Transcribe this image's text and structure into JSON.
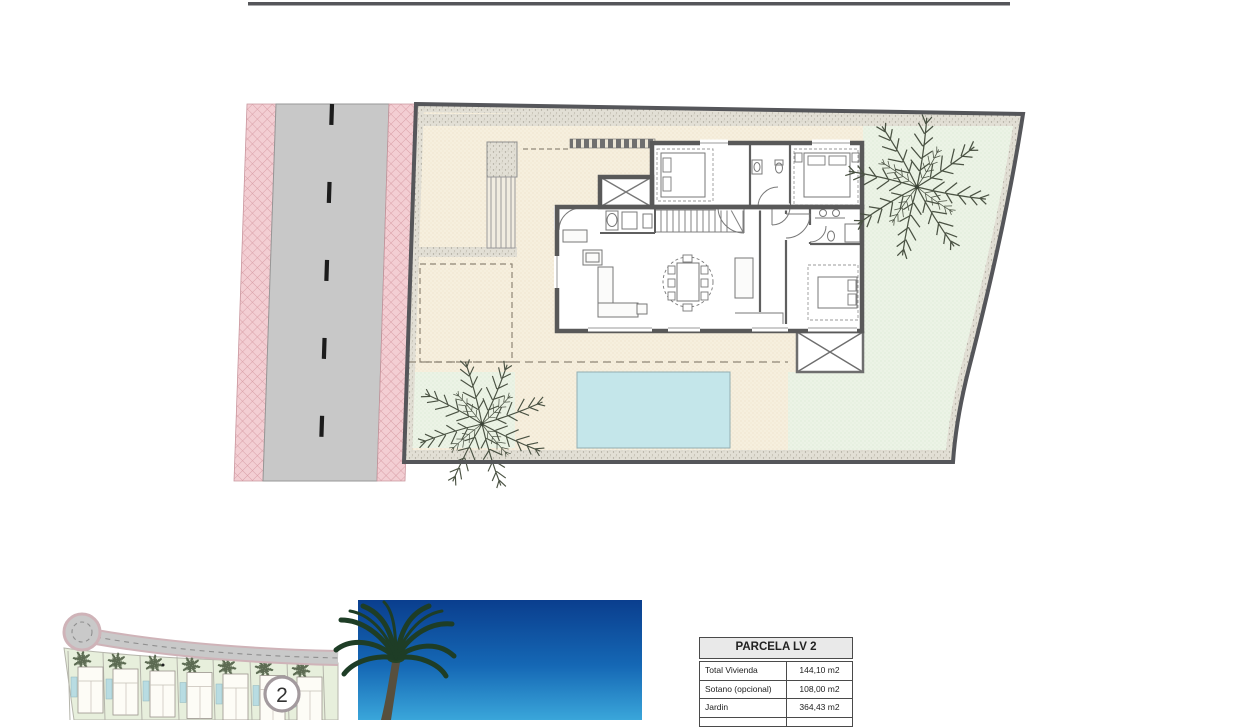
{
  "overview_map": {
    "marker_label": "2"
  },
  "spec_table": {
    "title": "PARCELA LV 2",
    "rows": [
      {
        "label": "Total Vivienda",
        "value": "144,10 m2"
      },
      {
        "label": "Sotano (opcional)",
        "value": "108,00 m2"
      },
      {
        "label": "Jardin",
        "value": "364,43 m2"
      }
    ]
  },
  "colors": {
    "sidewalk_pink": "#f3ced3",
    "road_gray": "#c8c8c8",
    "boundary_gray": "#55565a",
    "terrace_cream": "#f6efde",
    "garden_green": "#ecf3e6",
    "gravel_beige": "#e2dfd5",
    "pool_blue": "#c4e6ea",
    "wall_gray": "#595959",
    "sky_top_blue": "#0a3e8e",
    "sky_bottom_blue": "#3aa6da",
    "photo_palm_green": "#1e3d26"
  }
}
